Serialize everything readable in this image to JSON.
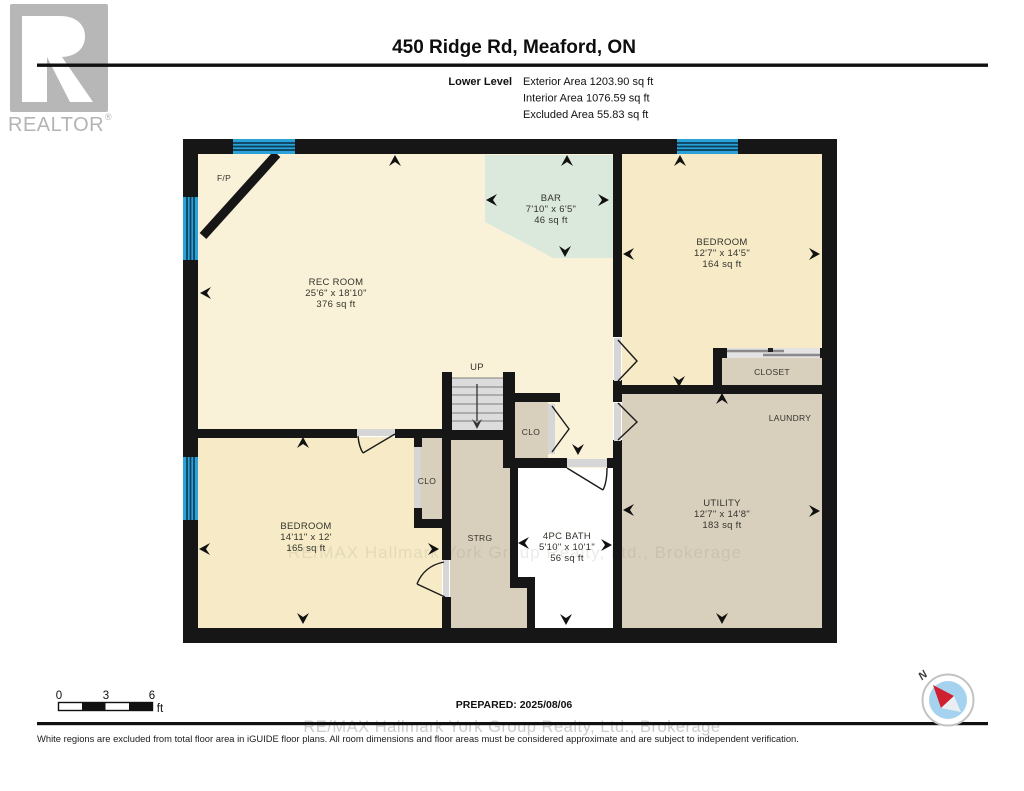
{
  "branding": {
    "logo_text": "REALTOR",
    "reg_mark": "®"
  },
  "header": {
    "title": "450 Ridge Rd, Meaford, ON",
    "level_label": "Lower Level",
    "exterior_area": "Exterior Area 1203.90 sq ft",
    "interior_area": "Interior Area 1076.59 sq ft",
    "excluded_area": "Excluded Area 55.83 sq ft"
  },
  "plan": {
    "rooms": {
      "rec_room": {
        "name": "REC ROOM",
        "dims": "25'6\" x 18'10\"",
        "area": "376 sq ft"
      },
      "bar": {
        "name": "BAR",
        "dims": "7'10\" x 6'5\"",
        "area": "46 sq ft"
      },
      "bedroom_upper": {
        "name": "BEDROOM",
        "dims": "12'7\" x 14'5\"",
        "area": "164 sq ft"
      },
      "closet": {
        "name": "CLOSET"
      },
      "laundry": {
        "name": "LAUNDRY"
      },
      "utility": {
        "name": "UTILITY",
        "dims": "12'7\" x 14'8\"",
        "area": "183 sq ft"
      },
      "bedroom_lower": {
        "name": "BEDROOM",
        "dims": "14'11\" x 12'",
        "area": "165 sq ft"
      },
      "bath": {
        "name": "4PC BATH",
        "dims": "5'10\" x 10'1\"",
        "area": "56 sq ft"
      },
      "storage": {
        "name": "STRG"
      },
      "closet_hall": {
        "name": "CLO"
      },
      "closet_bedroom": {
        "name": "CLO"
      },
      "fireplace": {
        "name": "F/P"
      },
      "stairs": {
        "name": "UP"
      }
    },
    "watermark": "RE/MAX Hallmark York Group Realty, Ltd., Brokerage",
    "colors": {
      "wall": "#161616",
      "floor_cream": "#faf2d8",
      "floor_yellow": "#f6ebc6",
      "floor_tan": "#d9cfbd",
      "floor_teal": "#dbe9dc",
      "bath_white": "#ffffff",
      "window_blue": "#2aa2d8"
    }
  },
  "footer": {
    "scale": {
      "tick0": "0",
      "tick1": "3",
      "tick2": "6",
      "unit": "ft"
    },
    "prepared": "PREPARED: 2025/08/06",
    "compass_label": "N",
    "watermark": "RE/MAX Hallmark York Group Realty, Ltd., Brokerage",
    "disclaimer": "White regions are excluded from total floor area in iGUIDE floor plans. All room dimensions and floor areas must be considered approximate and are subject to independent verification."
  }
}
